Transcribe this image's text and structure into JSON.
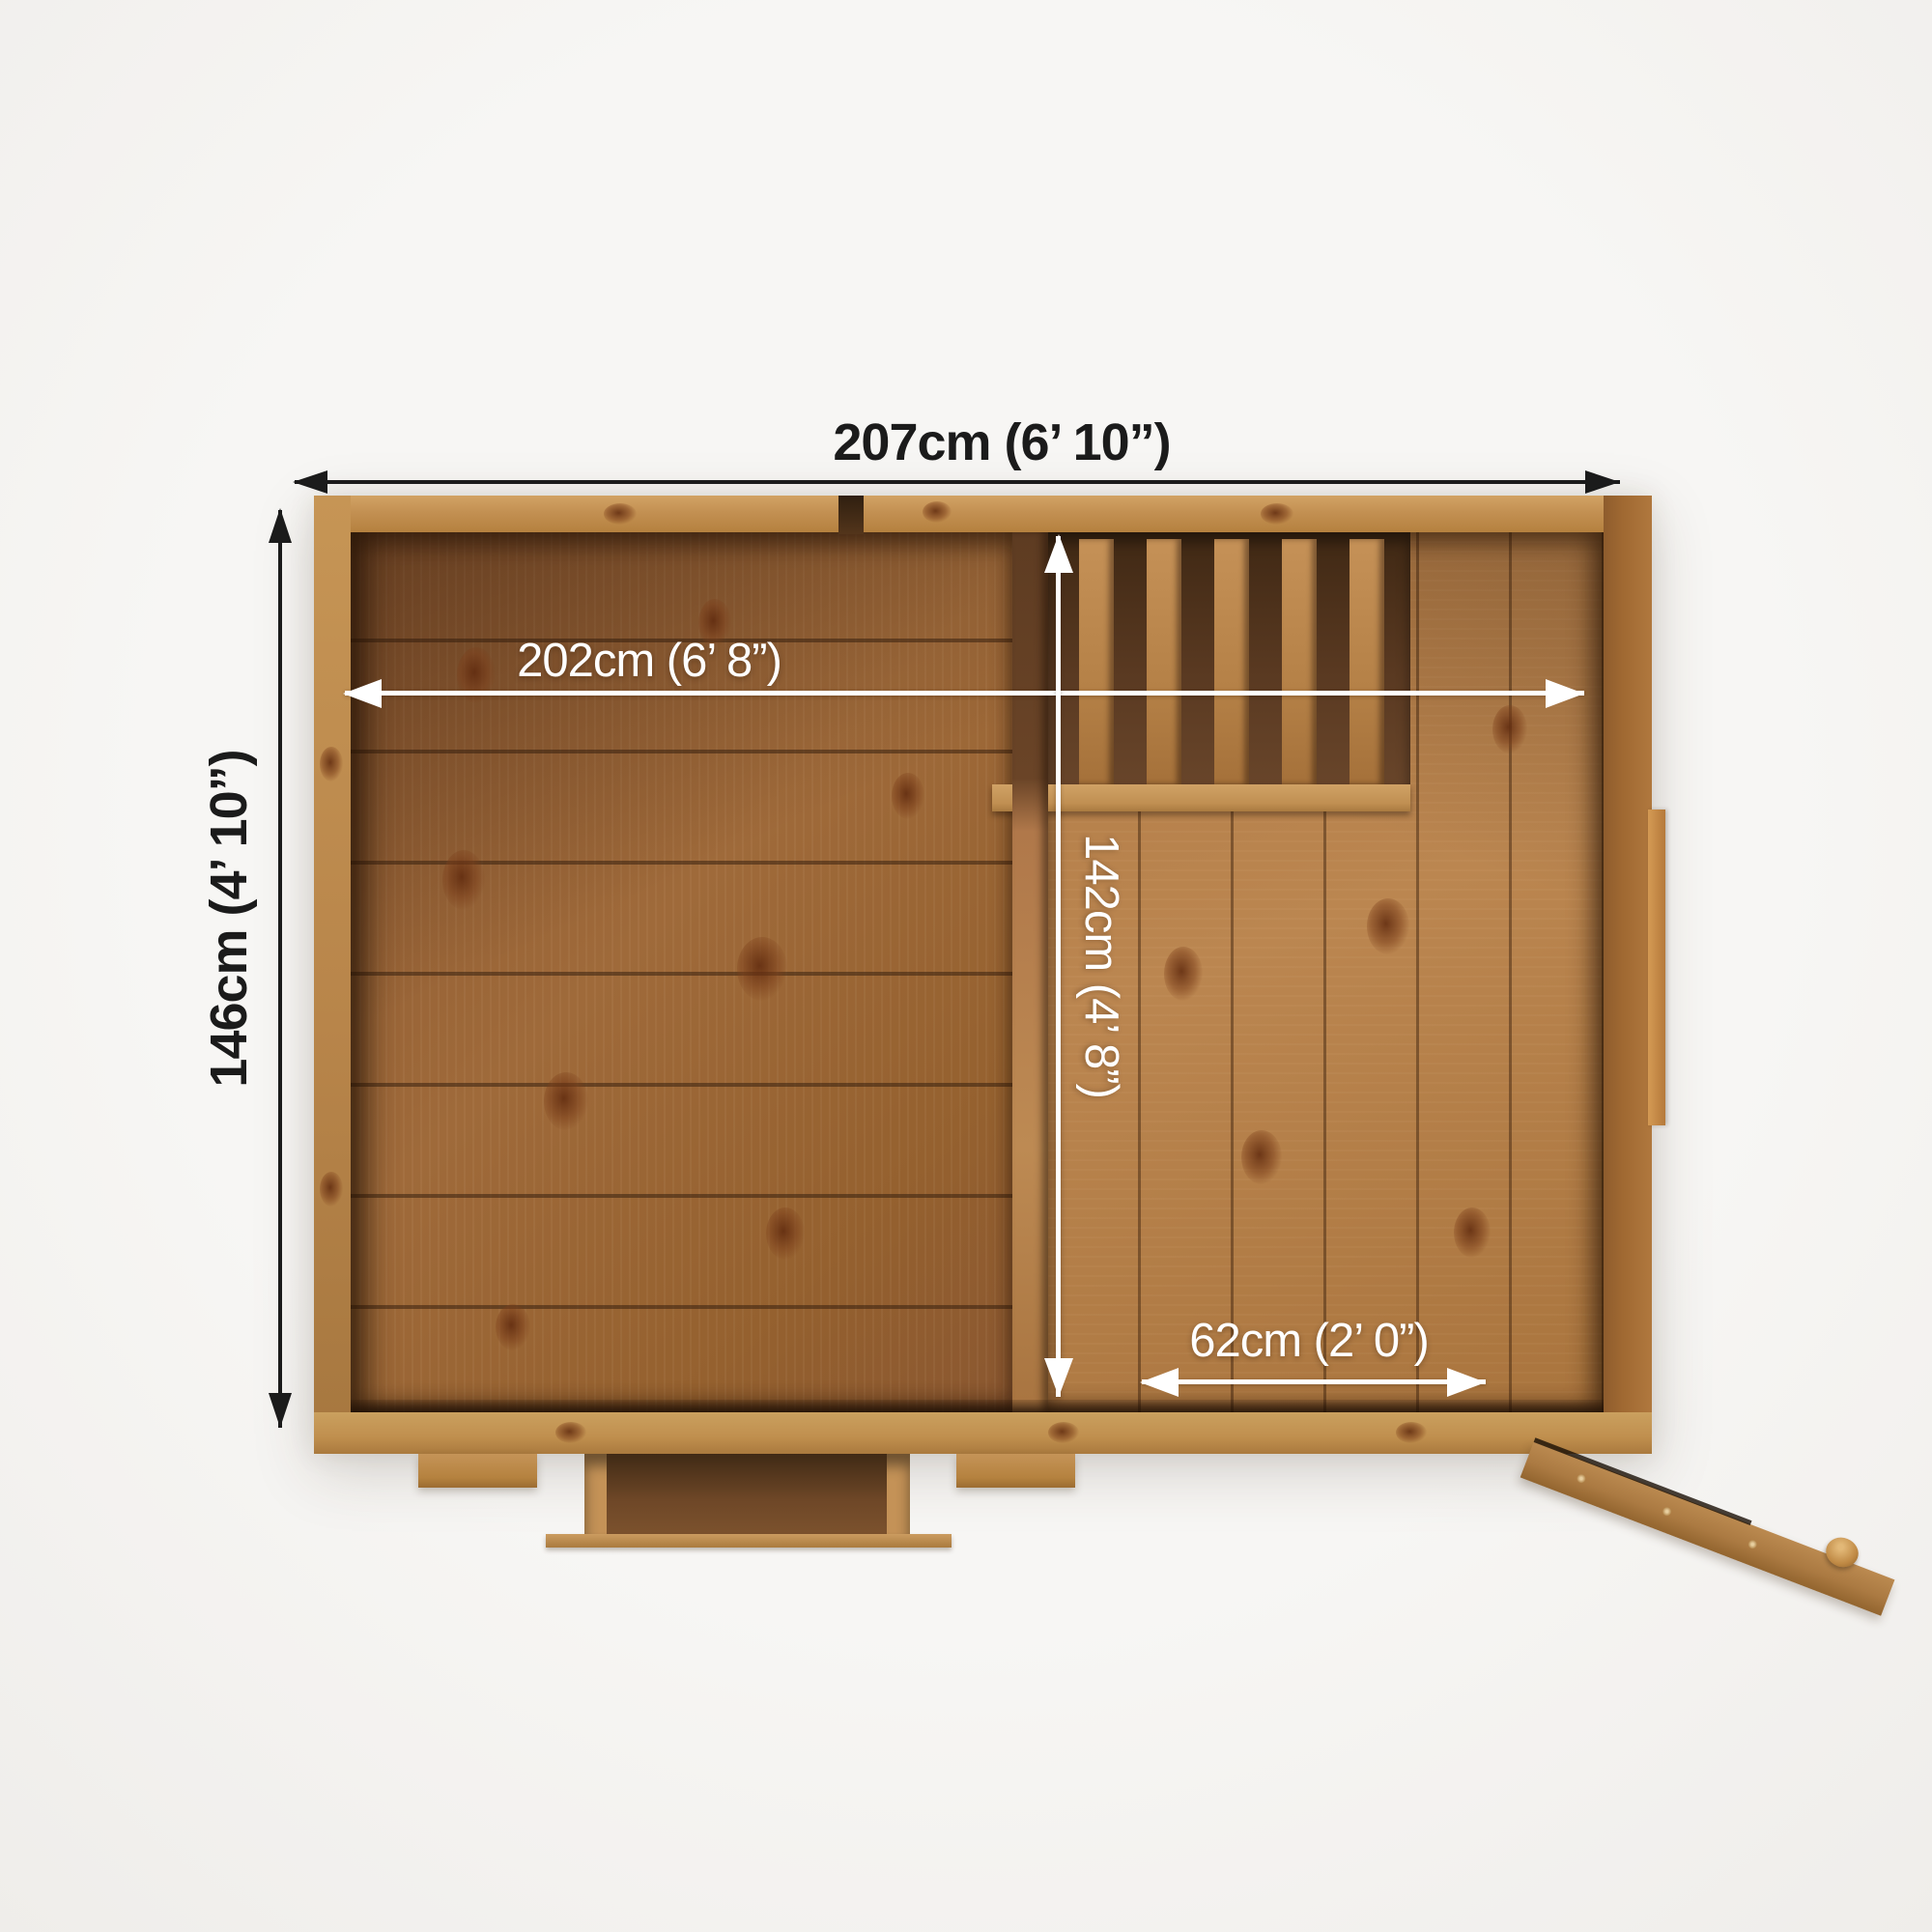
{
  "title": "Shed top-view floor plan with dimensions",
  "annotation_colors": {
    "outer_dimensions": "#1b1b1b",
    "inner_dimensions": "#ffffff"
  },
  "wood_colors": {
    "frame_tan": "#c39052",
    "left_floor": "#95612f",
    "right_floor": "#b07a45",
    "dark_recess": "#553620"
  },
  "dimensions": {
    "outer_width": {
      "cm": "207cm",
      "imperial": "6’ 10”",
      "label": "207cm (6’ 10”)"
    },
    "outer_depth": {
      "cm": "146cm",
      "imperial": "4’ 10”",
      "label": "146cm (4’ 10”)"
    },
    "inner_width": {
      "cm": "202cm",
      "imperial": "6’ 8”",
      "label": "202cm (6’ 8”)"
    },
    "inner_depth": {
      "cm": "142cm",
      "imperial": "4’ 8”",
      "label": "142cm (4’ 8”)"
    },
    "side_section": {
      "cm": "62cm",
      "imperial": "2’ 0”",
      "label": "62cm (2’ 0”)"
    }
  }
}
